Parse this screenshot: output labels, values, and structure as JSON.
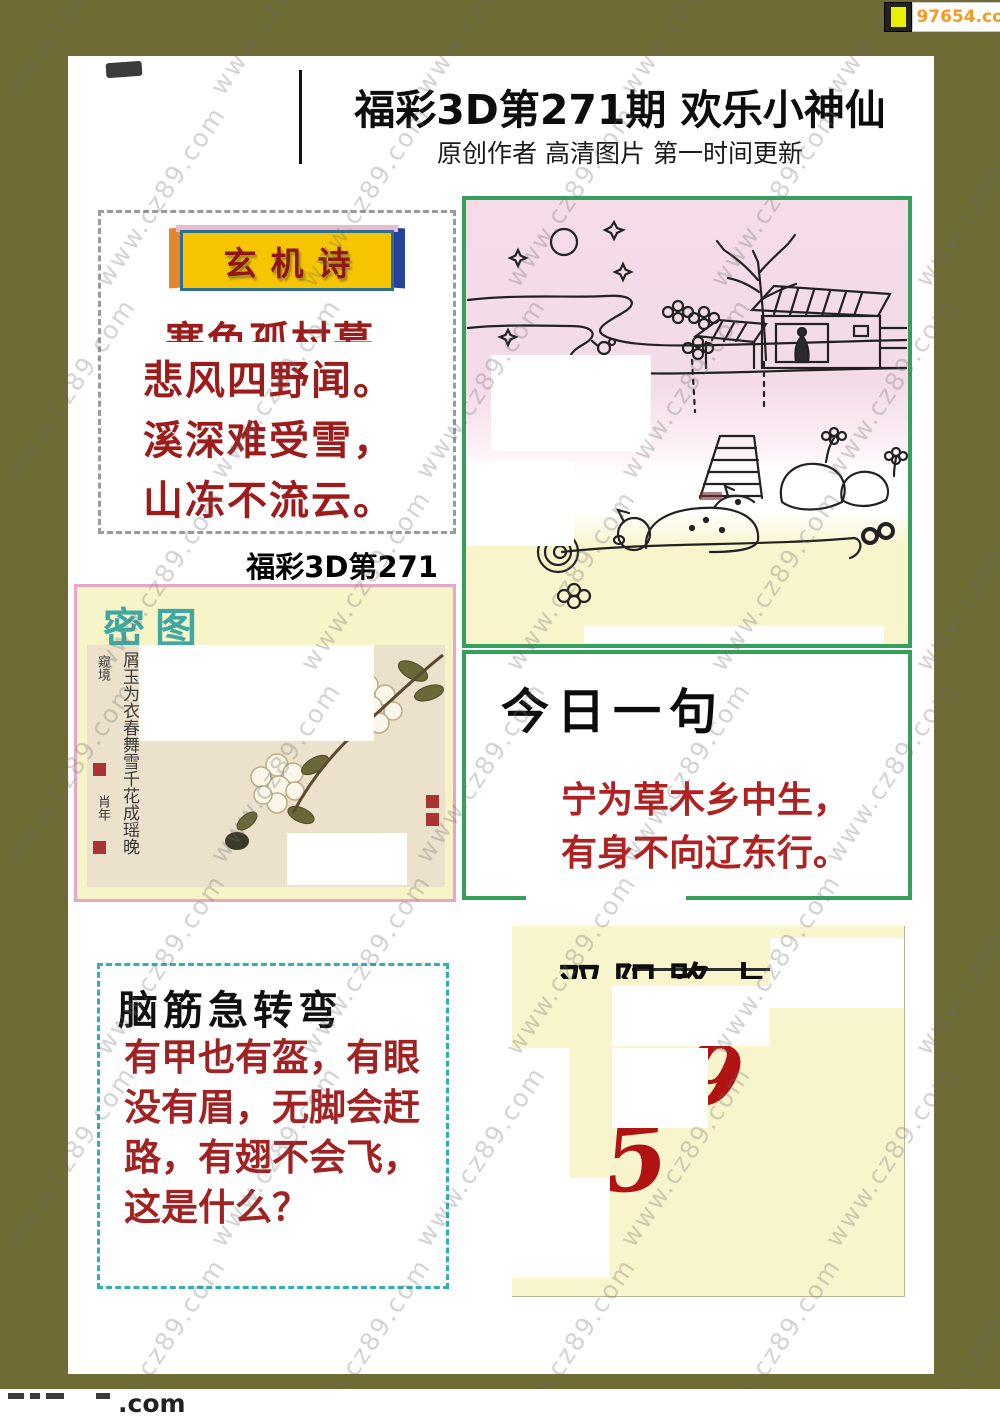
{
  "badge": {
    "label": "97654.com",
    "icon": "yellow-square-icon"
  },
  "header": {
    "title": "福彩3D第271期 欢乐小神仙",
    "subtitle": "原创作者  高清图片  第一时间更新"
  },
  "watermark": {
    "text": "www.cz89.com"
  },
  "xuanjishi": {
    "title": "玄机诗",
    "line1": "寒色孤村暮",
    "line2": "悲风四野闻。",
    "line3": "溪深难受雪，",
    "line4": "山冻不流云。"
  },
  "issue_label": "福彩3D第271期",
  "mitu": {
    "title": "密图",
    "inscription_small": "窥境",
    "inscription_main": "屑玉为衣春舞雪千花成瑶晚",
    "inscription_side": "肖年"
  },
  "jinri": {
    "title": "今日一句",
    "line1": "宁为草木乡中生，",
    "line2": "有身不向辽东行。"
  },
  "naojin": {
    "title": "脑筋急转弯",
    "text": "有甲也有盔，有眼没有眉，无脚会赶路，有翅不会飞，这是什么？"
  },
  "numbers": {
    "title": "双阳路上一",
    "n1": "5",
    "n2": "9"
  },
  "footer": {
    "suffix": ".com"
  },
  "colors": {
    "frame_olive": "#6e6b35",
    "banner_yellow": "#f7c500",
    "banner_red_text": "#8e1616",
    "poem_red": "#9c1c1c",
    "green_border": "#35a05c",
    "pink_border": "#e9a6c6",
    "teal_title": "#3fa8a2",
    "dashed_teal": "#2fb0b8",
    "number_red": "#b11212",
    "badge_orange": "#f59a23",
    "panel_yellow": "#f8f5cd"
  }
}
